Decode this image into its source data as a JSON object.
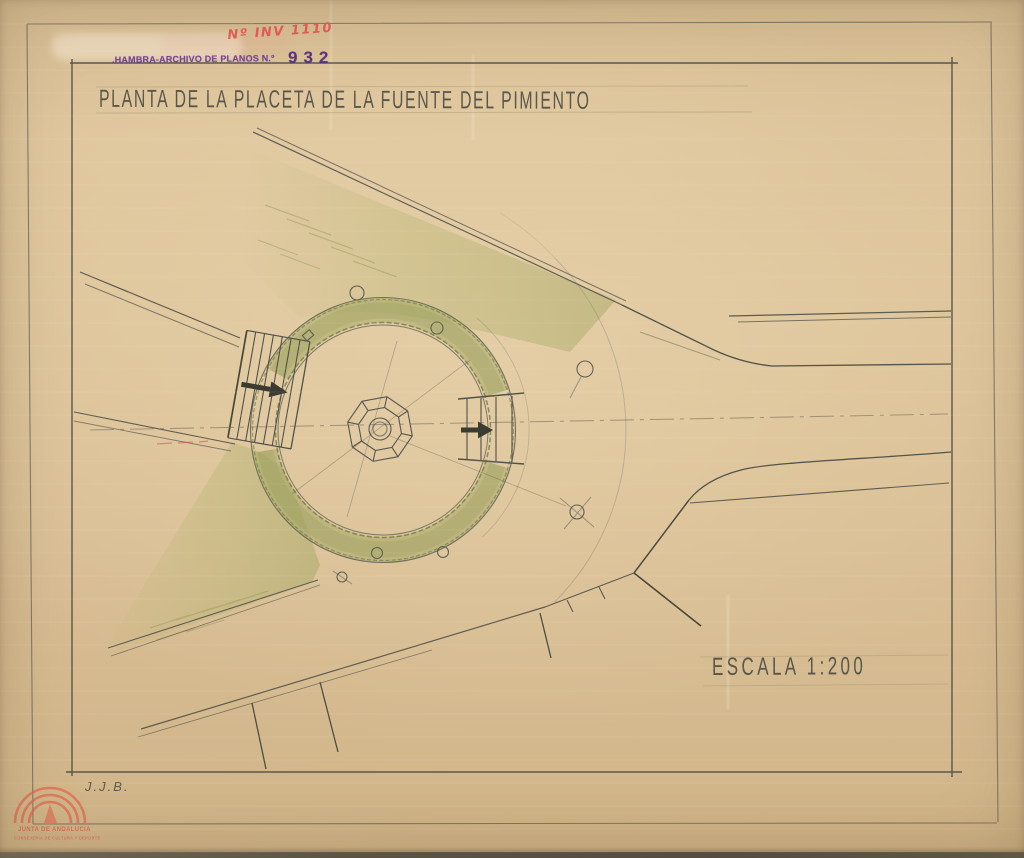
{
  "stamp": {
    "inventory_number_handwritten": "Nº INV 1110",
    "archive_text": ".HAMBRA-ARCHIVO DE PLANOS N.º",
    "plan_number": "932"
  },
  "drawing": {
    "title": "PLANTA DE LA PLACETA DE LA FUENTE DEL PIMIENTO",
    "scale_label": "ESCALA 1:200",
    "author_initials": "J.J.B."
  },
  "footer_logo": {
    "institution": "JUNTA DE ANDALUCIA",
    "department": "CONSEJERÍA DE CULTURA Y DEPORTE"
  },
  "colors": {
    "paper": "#dcc298",
    "pencil": "#54554b",
    "stamp_purple": "#5e2d86",
    "handwriting_red": "#ea4e4e",
    "logo_orange": "#df654d",
    "hedge_green": "#9aa35f"
  }
}
